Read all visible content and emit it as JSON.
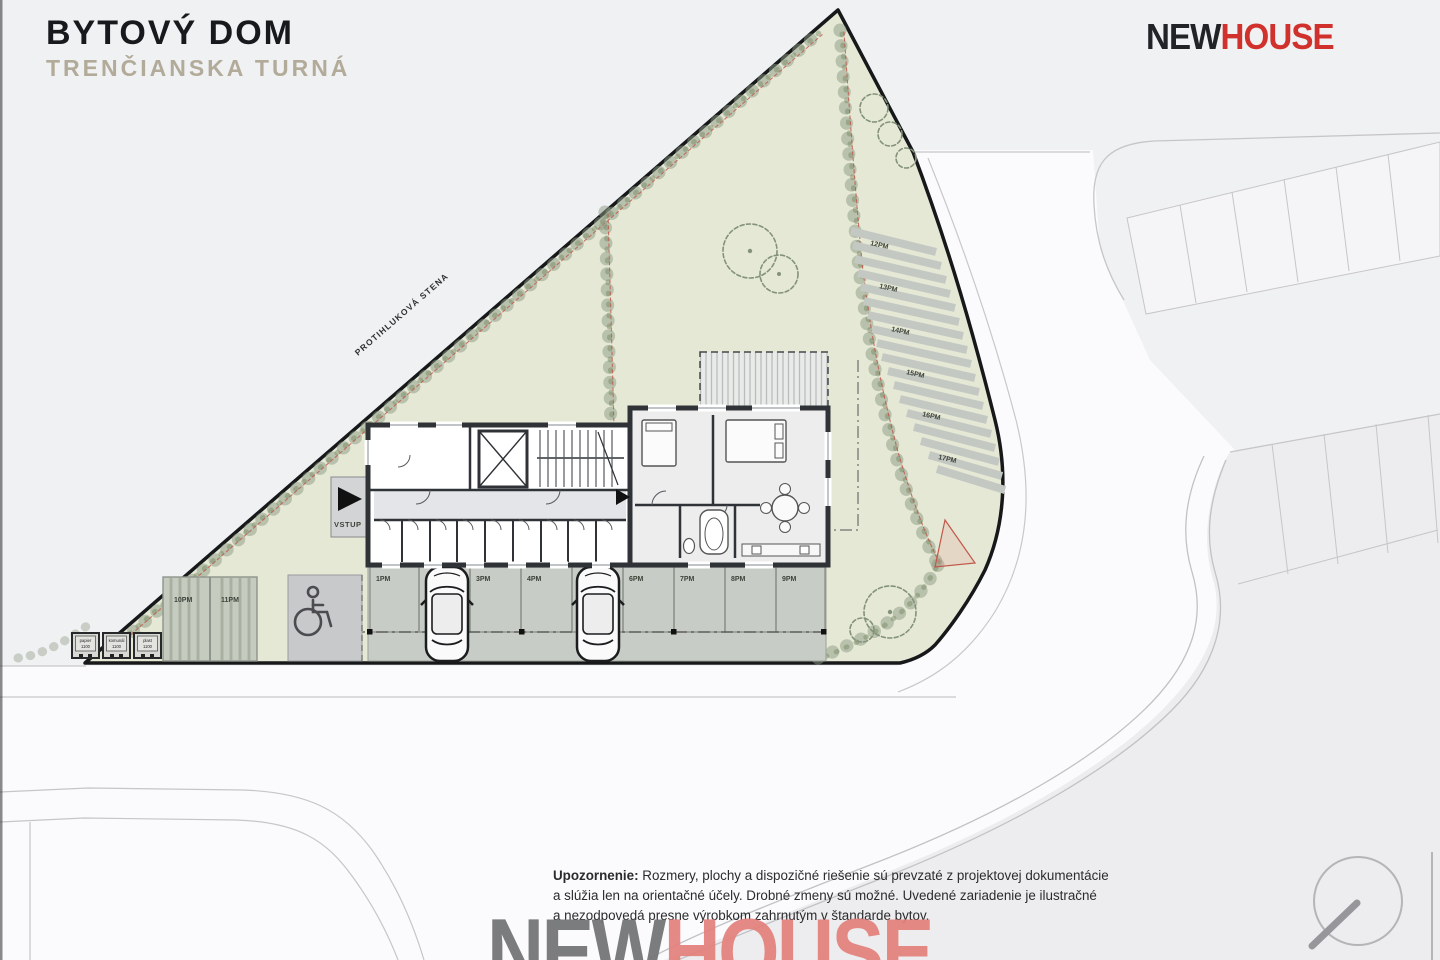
{
  "header": {
    "title": "BYTOVÝ DOM",
    "subtitle": "TRENČIANSKA TURNÁ"
  },
  "brand": {
    "new": "NEW",
    "house": "HOUSE"
  },
  "site_plan": {
    "noise_wall_label": "PROTIHLUKOVÁ STENA",
    "entrance_label": "VSTUP",
    "parking_row": {
      "labels": [
        "1PM",
        "2PM",
        "3PM",
        "4PM",
        "5PM",
        "6PM",
        "7PM",
        "8PM",
        "9PM"
      ]
    },
    "parking_left": {
      "labels": [
        "10PM",
        "11PM"
      ]
    },
    "parking_diagonal": {
      "labels": [
        "12PM",
        "13PM",
        "14PM",
        "15PM",
        "16PM",
        "17PM"
      ]
    },
    "waste_bins": [
      {
        "name": "papier",
        "size": "1100"
      },
      {
        "name": "komunál",
        "size": "1100"
      },
      {
        "name": "plast",
        "size": "1100"
      }
    ]
  },
  "footer": {
    "warning_label": "Upozornenie:",
    "line1": " Rozmery, plochy a dispozičné riešenie sú prevzaté z projektovej dokumentácie",
    "line2": "a slúžia len na orientačné účely. Drobné zmeny sú možné. Uvedené zariadenie je ilustračné",
    "line3": "a nezodpovedá presne výrobkom zahrnutým v štandarde bytov."
  },
  "watermark": {
    "new": "NEW",
    "house": "HOUSE"
  },
  "colors": {
    "brand_red": "#d0312d",
    "site_green": "#e4e8d5",
    "boundary_red": "#c2584a",
    "subtitle_beige": "#b3ab9a"
  }
}
